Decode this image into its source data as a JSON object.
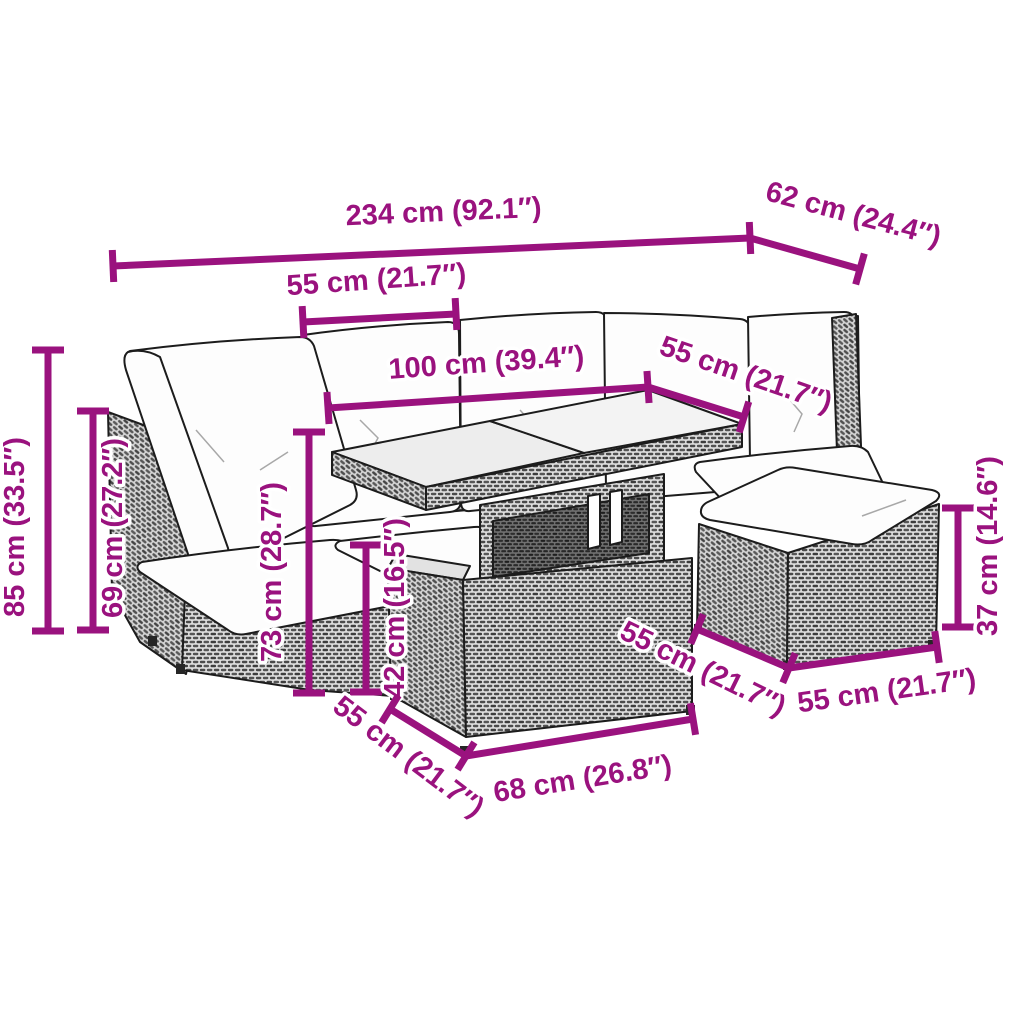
{
  "diagram": {
    "kind": "product-dimension-diagram",
    "background": "#ffffff",
    "accent_color": "#9a127e",
    "line_art_color": "#1c1c1c",
    "label_font_size": 29,
    "dimension_line_width": 7,
    "tick_half_length": 16
  },
  "dimensions": [
    {
      "name": "overall-width",
      "label": "234 cm (92.1″)",
      "line": {
        "x1": 113,
        "y1": 266,
        "x2": 750,
        "y2": 238
      },
      "ticks": "both",
      "text": {
        "x": 444,
        "y": 221,
        "rot": -2.5
      }
    },
    {
      "name": "overall-depth",
      "label": "62 cm (24.4″)",
      "line": {
        "x1": 750,
        "y1": 238,
        "x2": 860,
        "y2": 269
      },
      "ticks": "end",
      "text": {
        "x": 851,
        "y": 223,
        "rot": 15
      }
    },
    {
      "name": "seat-section-width",
      "label": "55 cm (21.7″)",
      "line": {
        "x1": 303,
        "y1": 322,
        "x2": 456,
        "y2": 314
      },
      "ticks": "both",
      "text": {
        "x": 377,
        "y": 289,
        "rot": -4
      }
    },
    {
      "name": "table-length",
      "label": "100 cm (39.4″)",
      "line": {
        "x1": 328,
        "y1": 408,
        "x2": 648,
        "y2": 387
      },
      "ticks": "both",
      "text": {
        "x": 487,
        "y": 372,
        "rot": -4
      }
    },
    {
      "name": "table-depth",
      "label": "55 cm (21.7″)",
      "line": {
        "x1": 648,
        "y1": 387,
        "x2": 744,
        "y2": 417
      },
      "ticks": "end",
      "text": {
        "x": 743,
        "y": 383,
        "rot": 19
      }
    },
    {
      "name": "back-height",
      "label": "85 cm (33.5″)",
      "line": {
        "x1": 48,
        "y1": 350,
        "x2": 48,
        "y2": 631
      },
      "ticks": "both",
      "text": {
        "x": 24,
        "y": 527,
        "rot": -90
      }
    },
    {
      "name": "arm-height",
      "label": "69 cm (27.2″)",
      "line": {
        "x1": 93,
        "y1": 411,
        "x2": 93,
        "y2": 630
      },
      "ticks": "both",
      "text": {
        "x": 122,
        "y": 528,
        "rot": -90
      }
    },
    {
      "name": "table-height",
      "label": "73 cm (28.7″)",
      "line": {
        "x1": 309,
        "y1": 432,
        "x2": 309,
        "y2": 693
      },
      "ticks": "both",
      "text": {
        "x": 281,
        "y": 572,
        "rot": -90
      }
    },
    {
      "name": "stool-height",
      "label": "42 cm (16.5″)",
      "line": {
        "x1": 366,
        "y1": 545,
        "x2": 366,
        "y2": 692
      },
      "ticks": "both",
      "text": {
        "x": 404,
        "y": 608,
        "rot": -90
      }
    },
    {
      "name": "stool-depth",
      "label": "55 cm (21.7″)",
      "line": {
        "x1": 390,
        "y1": 709,
        "x2": 466,
        "y2": 756
      },
      "ticks": "both",
      "text": {
        "x": 403,
        "y": 764,
        "rot": 37
      }
    },
    {
      "name": "stool-width",
      "label": "68 cm (26.8″)",
      "line": {
        "x1": 466,
        "y1": 756,
        "x2": 693,
        "y2": 719
      },
      "ticks": "end",
      "text": {
        "x": 584,
        "y": 788,
        "rot": -9
      }
    },
    {
      "name": "ottoman-depth",
      "label": "55 cm (21.7″)",
      "line": {
        "x1": 697,
        "y1": 629,
        "x2": 789,
        "y2": 668
      },
      "ticks": "both",
      "text": {
        "x": 699,
        "y": 677,
        "rot": 26
      }
    },
    {
      "name": "ottoman-width",
      "label": "55 cm (21.7″)",
      "line": {
        "x1": 789,
        "y1": 668,
        "x2": 937,
        "y2": 647
      },
      "ticks": "end",
      "text": {
        "x": 888,
        "y": 700,
        "rot": -8
      }
    },
    {
      "name": "ottoman-height",
      "label": "37 cm (14.6″)",
      "line": {
        "x1": 958,
        "y1": 508,
        "x2": 958,
        "y2": 627
      },
      "ticks": "both",
      "text": {
        "x": 997,
        "y": 546,
        "rot": -90
      }
    }
  ]
}
